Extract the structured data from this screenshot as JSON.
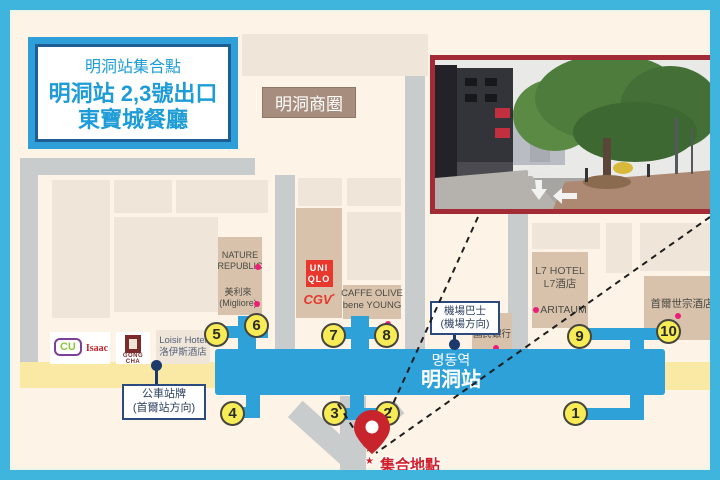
{
  "colors": {
    "frame_blue": "#3FB5DE",
    "station_blue": "#2EA1D9",
    "background_cream": "#FDF3E6",
    "building_tan": "#D8C2AB",
    "building_light": "#EFE5D9",
    "road_gray": "#C9CCCD",
    "road_yellow": "#FAE8A5",
    "exit_yellow": "#F7EB56",
    "pin_red": "#C8242E",
    "photo_border_red": "#A32B36",
    "area_label_brown": "#A68D7D",
    "navy": "#2B4A7D",
    "store_dot_pink": "#ED1E79",
    "title_blue": "#1E9CD7",
    "meeting_red": "#D1202C"
  },
  "title_box": {
    "tag": "明洞站集合點",
    "line1": "明洞站 2,3號出口",
    "line2": "東寶城餐廳"
  },
  "area_label": "明洞商圈",
  "station": {
    "korean": "명동역",
    "chinese": "明洞站"
  },
  "exits": [
    "1",
    "2",
    "3",
    "4",
    "5",
    "6",
    "7",
    "8",
    "9",
    "10"
  ],
  "stores": {
    "nature_republic_l1": "NATURE",
    "nature_republic_l2": "REPUBLIC",
    "migliore_l1": "美利來",
    "migliore_l2": "(Migliore)",
    "uniqlo_l1": "UNI",
    "uniqlo_l2": "QLO",
    "cgv": "CGV",
    "caffe_olive_l1": "CAFFE OLIVE",
    "caffe_olive_l2": "bene YOUNG",
    "cu": "CU",
    "isaac": "Isaac",
    "gongcha": "GONG CHA",
    "loisir_l1": "Loisir Hotel",
    "loisir_l2": "洛伊斯酒店",
    "kb_l1": "KB",
    "kb_l2": "國民銀行",
    "l7_l1": "L7 HOTEL",
    "l7_l2": "L7酒店",
    "aritaum": "ARITAUM",
    "sejong": "首爾世宗酒店"
  },
  "labels": {
    "bus_stop_l1": "公車站牌",
    "bus_stop_l2": "(首爾站方向)",
    "airport_bus_l1": "機場巴士",
    "airport_bus_l2": "(機場方向)",
    "meeting_point": "集合地點",
    "meeting_star": "★"
  }
}
